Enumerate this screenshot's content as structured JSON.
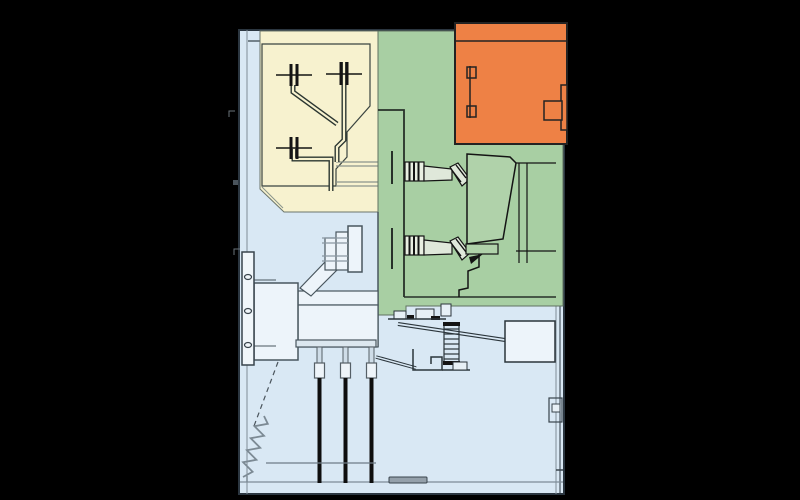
{
  "diagram": {
    "type": "technical-cross-section",
    "subject": "medium-voltage switchgear panel, side view",
    "visible_text": [],
    "background": "#000000",
    "colors": {
      "cabinet_fill": "#d9e8f4",
      "cabinet_outline": "#2b3640",
      "busbar_compartment": "#f7f2cf",
      "breaker_compartment": "#a8cfa3",
      "breaker_pole_fill": "#b0d2aa",
      "bushing_fill": "#e9efe2",
      "lv_compartment": "#ee8145",
      "duct_fill": "#edf4fa",
      "plate_fill": "#dce7ef",
      "line_dark": "#1c262c",
      "line_gray": "#6e7e8a",
      "cable_black": "#0e0e0e",
      "sill_gray": "#94a0aa"
    },
    "compartments": [
      {
        "name": "busbar-compartment",
        "color_key": "busbar_compartment"
      },
      {
        "name": "circuit-breaker-compartment",
        "color_key": "breaker_compartment"
      },
      {
        "name": "low-voltage-compartment",
        "color_key": "lv_compartment"
      },
      {
        "name": "cable-compartment",
        "color_key": "cabinet_fill"
      }
    ],
    "elements": [
      "busbar-cross-sections",
      "busbar-conductors",
      "breaker-bushings",
      "vacuum-breaker-pole",
      "breaker-truck-frame",
      "lv-door-handle",
      "lv-door-hinges",
      "wall-bushing-plate",
      "cable-ducts",
      "cable-terminations",
      "power-cables",
      "earthing-spring",
      "mounting-rail",
      "current-transformer-box",
      "operating-mechanism",
      "wall-bracket",
      "floor-sill",
      "reference-ticks"
    ]
  }
}
